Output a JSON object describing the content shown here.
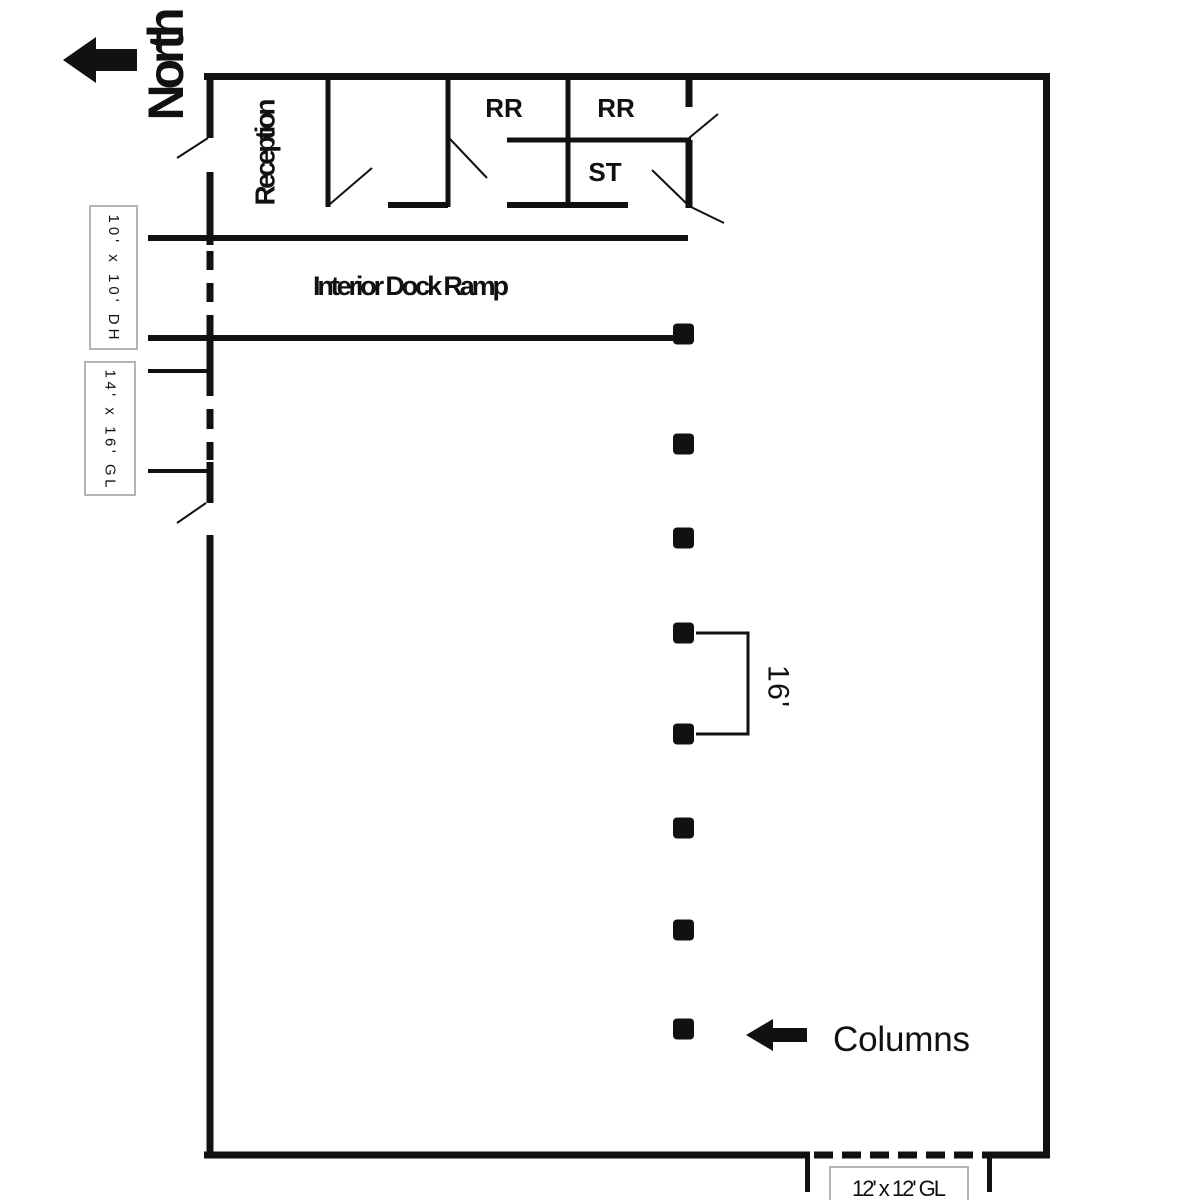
{
  "compass": {
    "label": "North"
  },
  "office": {
    "reception_label": "Reception",
    "restroom_left_label": "RR",
    "restroom_right_label": "RR",
    "storage_label": "ST"
  },
  "dock": {
    "ramp_label": "Interior Dock Ramp",
    "door_high_label": "10' x 10' DH",
    "door_grade_left_label": "14' x 16' GL",
    "door_grade_bottom_label": "12' x 12' GL"
  },
  "columns": {
    "label": "Columns",
    "spacing_label": "16'",
    "marker_x": 673,
    "marker_size": 21,
    "centers_y": [
      334,
      444,
      538,
      633,
      734,
      828,
      930,
      1029
    ]
  },
  "colors": {
    "ink": "#111111",
    "label_box_border": "#b3b3b3",
    "background": "#ffffff"
  }
}
